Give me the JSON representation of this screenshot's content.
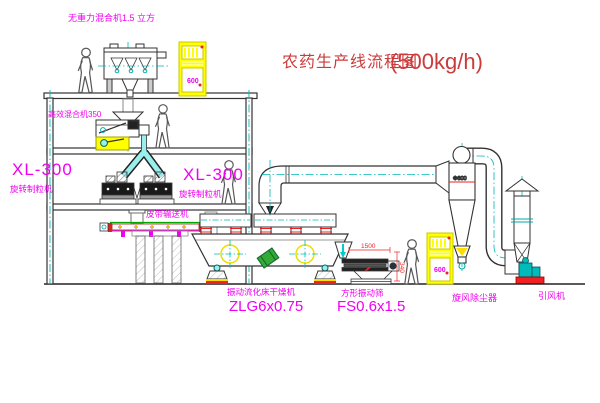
{
  "title": {
    "text": "农药生产线流程图",
    "capacity": "(500kg/h)"
  },
  "labels": {
    "gravity_mixer": "无重力混合机1.5 立方",
    "high_eff_mixer": "高效混合机350",
    "granulator_left": {
      "model": "XL-300",
      "name": "旋转制粒机"
    },
    "granulator_right": {
      "model": "XL-300",
      "name": "旋转制粒机"
    },
    "belt_conveyor": "皮带输送机",
    "dryer": {
      "name": "振动流化床干燥机",
      "model": "ZLG6x0.75"
    },
    "sieve": {
      "name": "方形振动筛",
      "model": "FS0.6x1.5"
    },
    "cyclone": {
      "name": "旋风除尘器",
      "size": "Φ600"
    },
    "fan": "引风机"
  },
  "dimensions": {
    "sieve_length": "1500",
    "sieve_height": "340"
  },
  "control_cabinet": {
    "display": "600"
  },
  "colors": {
    "label_magenta": "#f000f0",
    "title_red": "#cc3b3b",
    "dimension_red": "#ee2222",
    "centerline_teal": "#00b8b8",
    "cabinet_yellow": "#ffff00",
    "conveyor_green": "#00a800"
  }
}
